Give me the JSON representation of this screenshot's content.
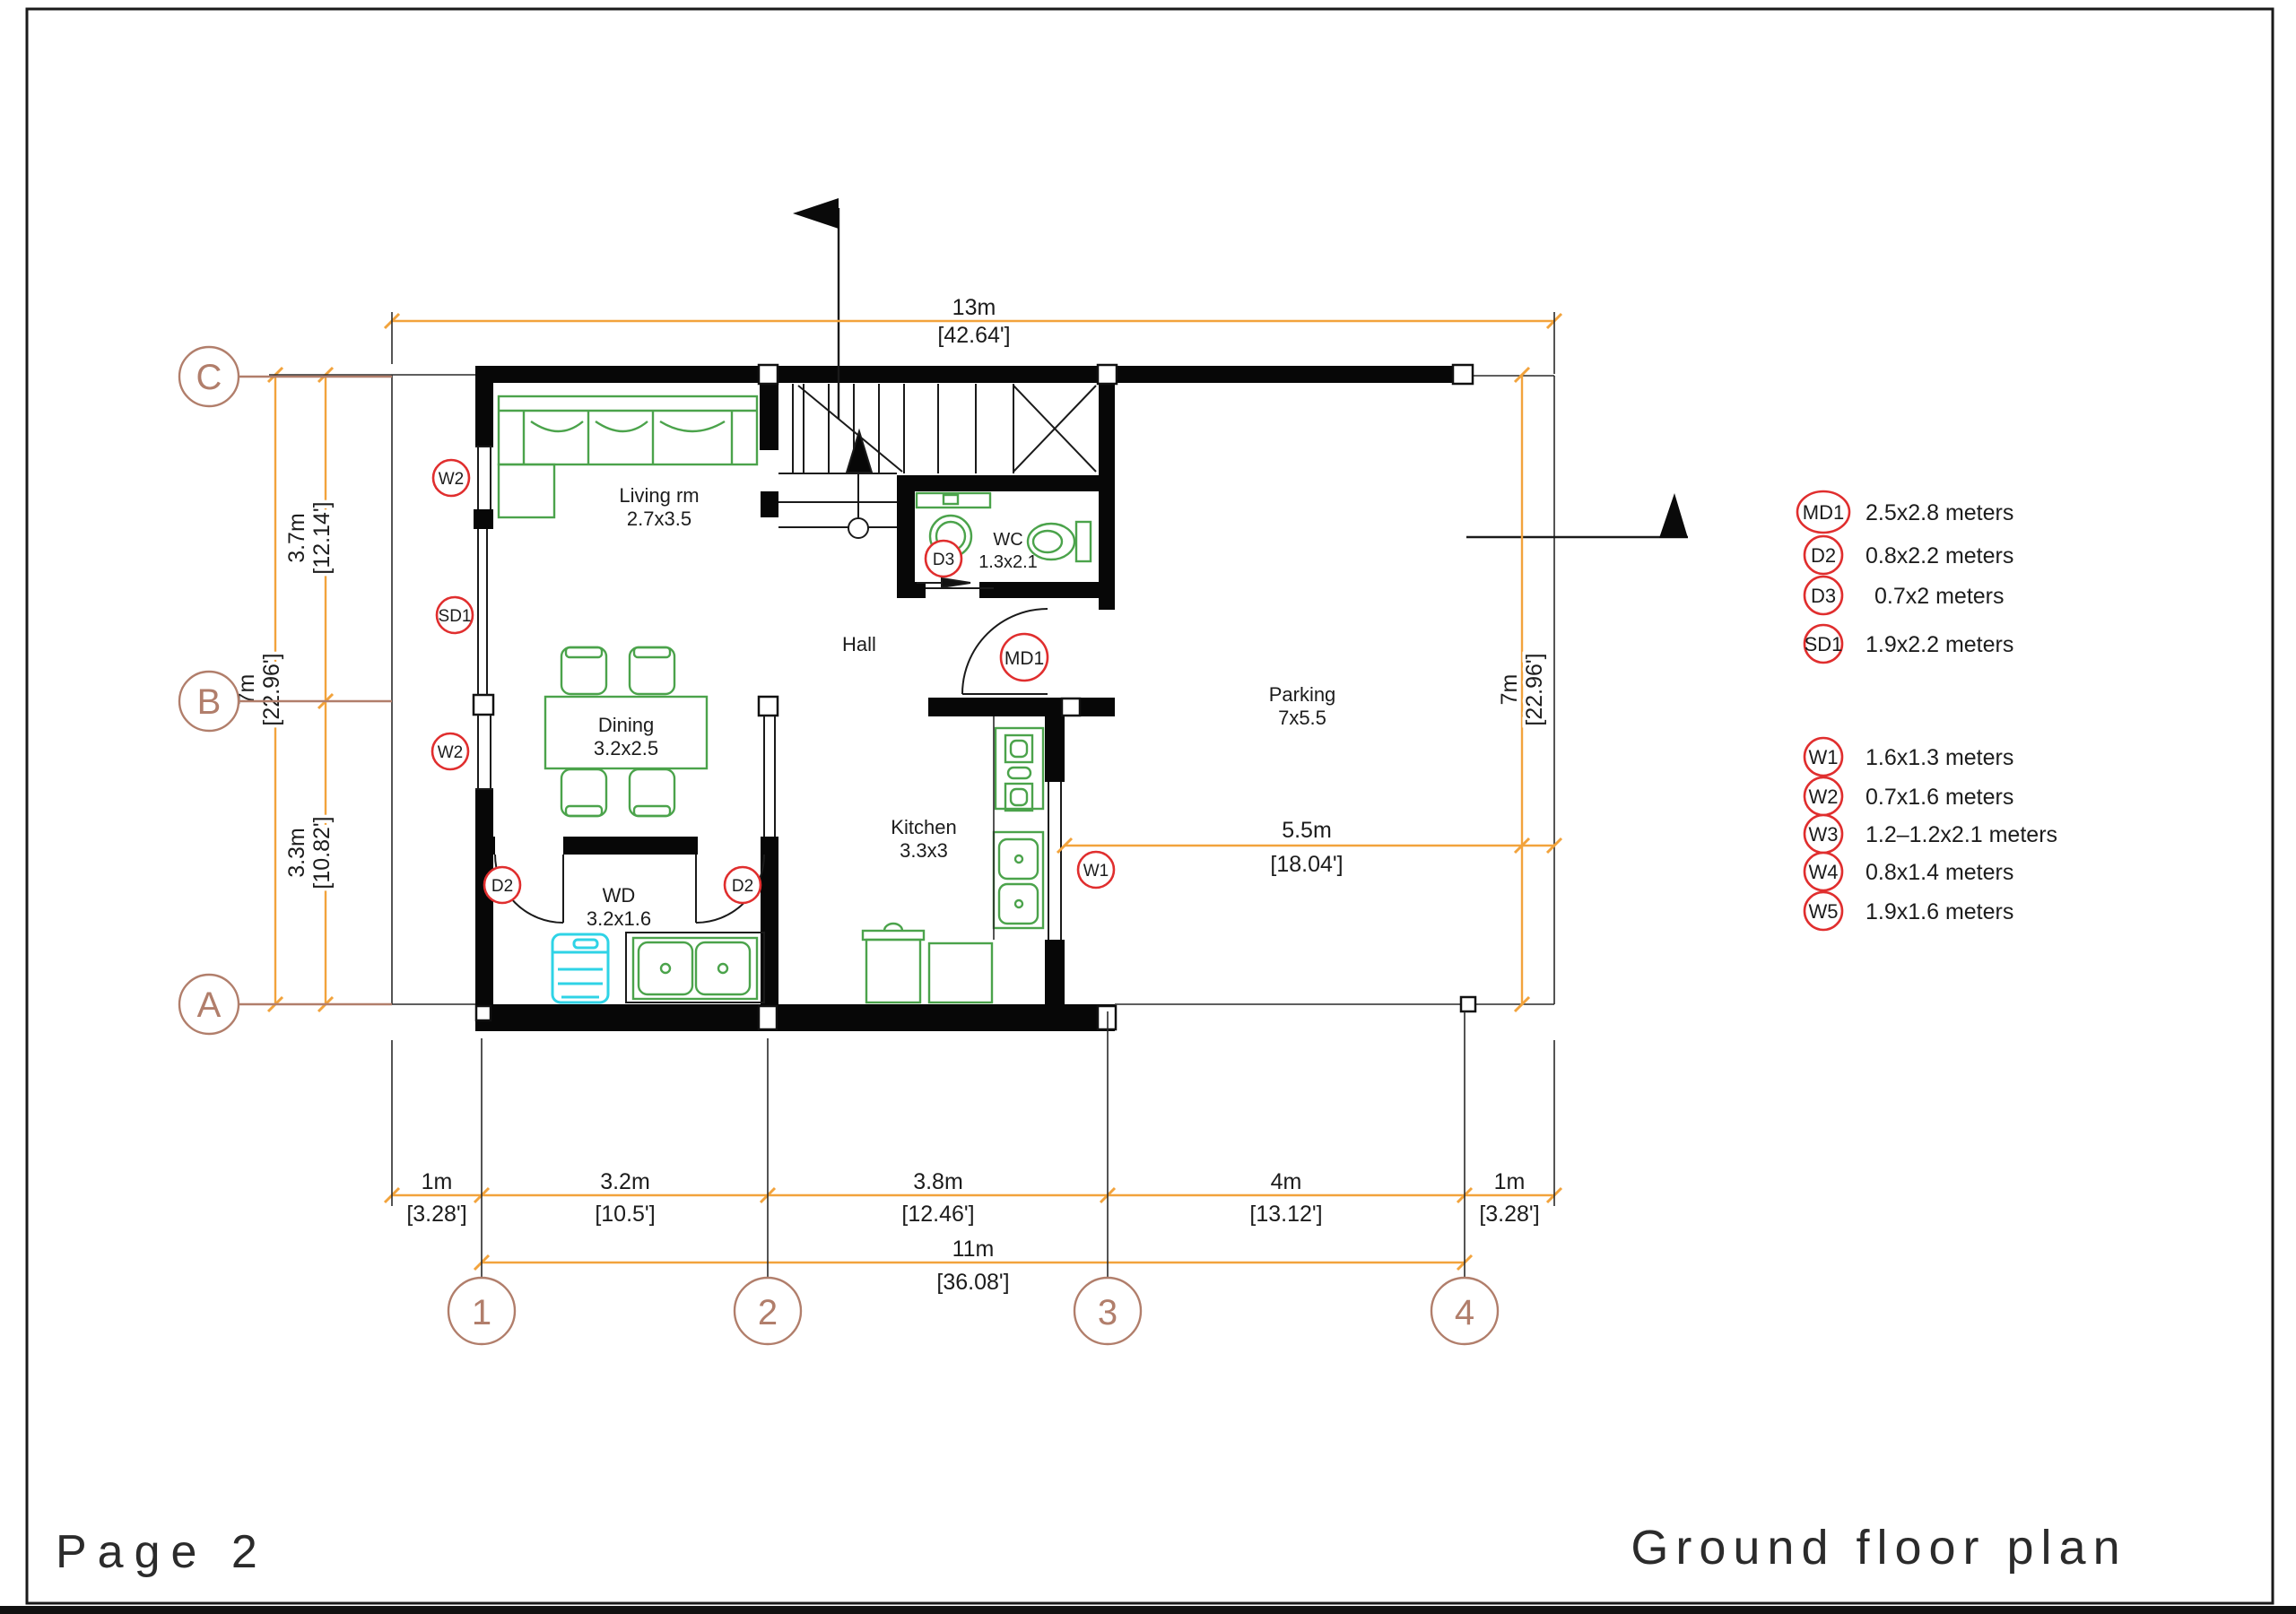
{
  "page": {
    "number_label": "Page 2",
    "plan_title": "Ground floor plan"
  },
  "colors": {
    "wall": "#070707",
    "furniture_green": "#4ba34b",
    "appliance_cyan": "#2fd3e6",
    "tag_red": "#e02e2e",
    "grid_brown": "#b17e6b",
    "dimension_orange": "#f2a33c"
  },
  "grid": {
    "rows": [
      "C",
      "B",
      "A"
    ],
    "cols": [
      "1",
      "2",
      "3",
      "4"
    ]
  },
  "dimensions": {
    "top": {
      "meters": "13m",
      "feet": "[42.64']"
    },
    "left_upper": {
      "meters": "3.7m",
      "feet": "[12.14']"
    },
    "left_lower": {
      "meters": "3.3m",
      "feet": "[10.82']"
    },
    "left_total": {
      "meters": "7m",
      "feet": "[22.96']"
    },
    "right_total": {
      "meters": "7m",
      "feet": "[22.96']"
    },
    "parking_width": {
      "meters": "5.5m",
      "feet": "[18.04']"
    },
    "bottom_segments": [
      {
        "meters": "1m",
        "feet": "[3.28']"
      },
      {
        "meters": "3.2m",
        "feet": "[10.5']"
      },
      {
        "meters": "3.8m",
        "feet": "[12.46']"
      },
      {
        "meters": "4m",
        "feet": "[13.12']"
      },
      {
        "meters": "1m",
        "feet": "[3.28']"
      }
    ],
    "bottom_total": {
      "meters": "11m",
      "feet": "[36.08']"
    }
  },
  "rooms": {
    "living": {
      "name": "Living rm",
      "size": "2.7x3.5"
    },
    "dining": {
      "name": "Dining",
      "size": "3.2x2.5"
    },
    "wd": {
      "name": "WD",
      "size": "3.2x1.6"
    },
    "wc": {
      "name": "WC",
      "size": "1.3x2.1"
    },
    "kitchen": {
      "name": "Kitchen",
      "size": "3.3x3"
    },
    "hall": {
      "name": "Hall"
    },
    "parking": {
      "name": "Parking",
      "size": "7x5.5"
    }
  },
  "plan_tags": {
    "window_left_top": "W2",
    "sliding_door": "SD1",
    "window_left_bottom": "W2",
    "door_wd_left": "D2",
    "door_wd_right": "D2",
    "door_wc": "D3",
    "main_door": "MD1",
    "window_kitchen": "W1"
  },
  "legend": {
    "doors": [
      {
        "tag": "MD1",
        "size": "2.5x2.8  meters"
      },
      {
        "tag": "D2",
        "size": "0.8x2.2  meters"
      },
      {
        "tag": "D3",
        "size": "0.7x2  meters"
      },
      {
        "tag": "SD1",
        "size": "1.9x2.2  meters"
      }
    ],
    "windows": [
      {
        "tag": "W1",
        "size": "1.6x1.3  meters"
      },
      {
        "tag": "W2",
        "size": "0.7x1.6  meters"
      },
      {
        "tag": "W3",
        "size": "1.2–1.2x2.1  meters"
      },
      {
        "tag": "W4",
        "size": "0.8x1.4  meters"
      },
      {
        "tag": "W5",
        "size": "1.9x1.6  meters"
      }
    ]
  }
}
